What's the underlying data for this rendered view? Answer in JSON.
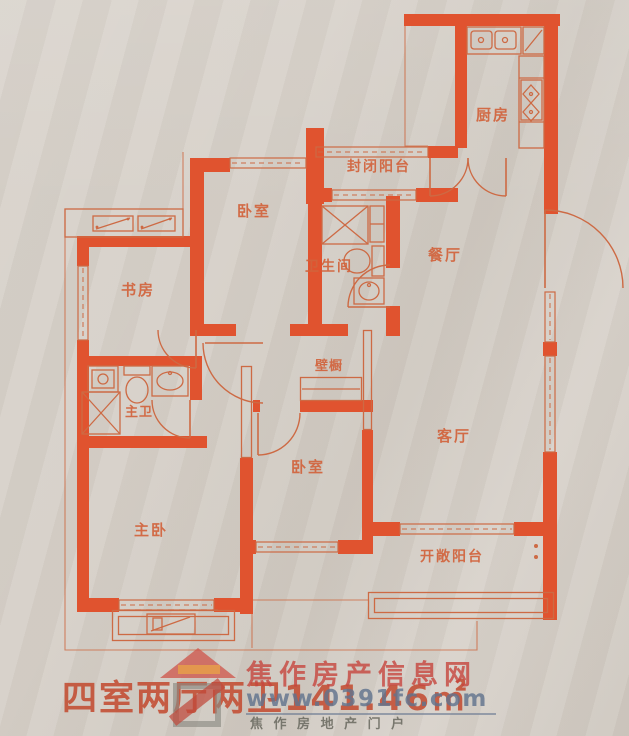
{
  "rooms": {
    "kitchen": {
      "label": "厨房"
    },
    "enclosed_balcony": {
      "label": "封闭阳台"
    },
    "bedroom_top": {
      "label": "卧室"
    },
    "study": {
      "label": "书房"
    },
    "bathroom": {
      "label": "卫生间"
    },
    "dining": {
      "label": "餐厅"
    },
    "master_bath": {
      "label": "主卫"
    },
    "closet": {
      "label": "壁橱"
    },
    "living": {
      "label": "客厅"
    },
    "bedroom_mid": {
      "label": "卧室"
    },
    "master_bedroom": {
      "label": "主卧"
    },
    "open_balcony": {
      "label": "开敞阳台"
    }
  },
  "caption": {
    "text": "四室两厅两卫141.46㎡"
  },
  "watermark": {
    "site_name": "焦作房产信息网",
    "url": "www.0391fc.com",
    "tagline": "焦 作 房 地 产 门 户"
  },
  "colors": {
    "background": "#d6d0c8",
    "wall": "#e0532f",
    "line": "#cd6a44",
    "label": "#d2633c",
    "caption": "#c3492e",
    "watermark_red": "#c7463e",
    "watermark_blue": "#62748e",
    "watermark_gray": "#69695f"
  }
}
